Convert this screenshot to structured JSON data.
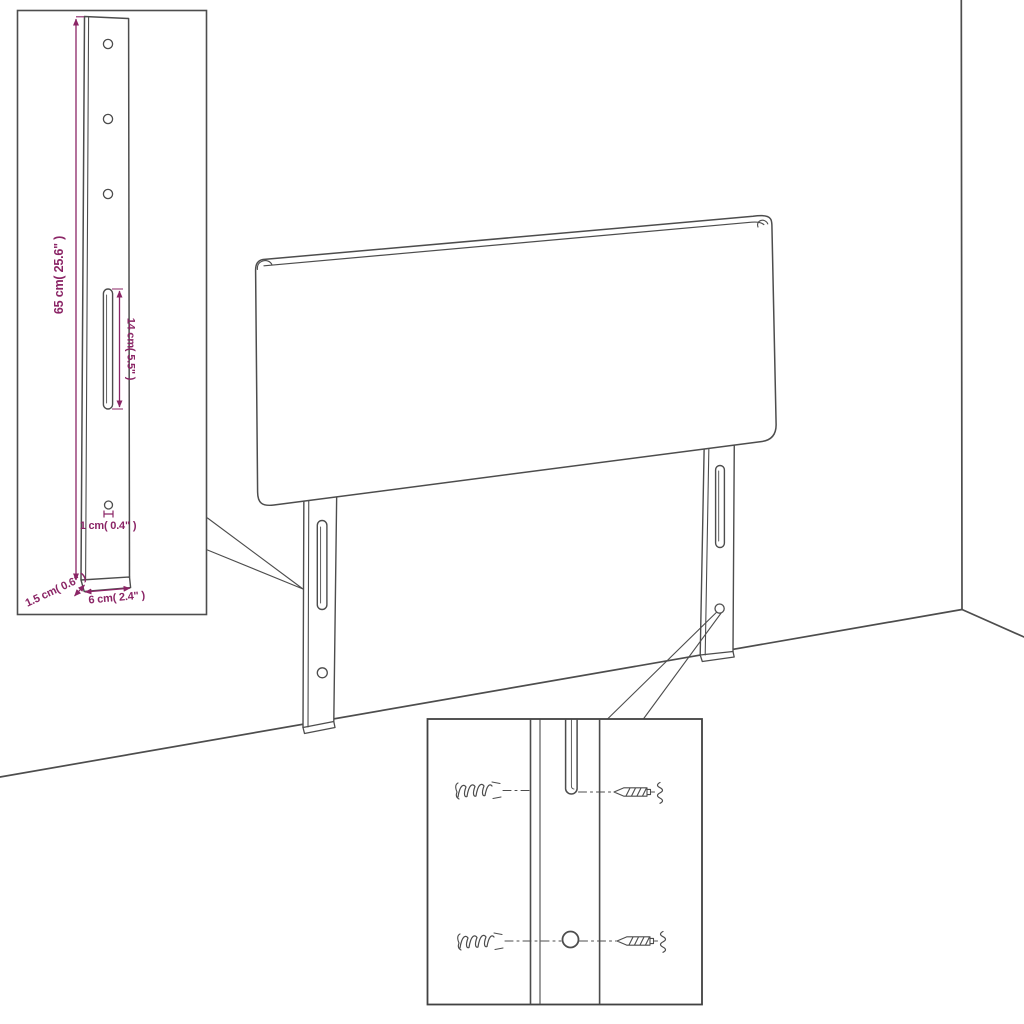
{
  "title": "Headboard mounting diagram",
  "colors": {
    "background": "#ffffff",
    "line": "#4d4d4d",
    "dimension": "#8b2566"
  },
  "leg_detail_inset": {
    "dimensions": {
      "height": "65 cm( 25.6\" )",
      "slot_length": "14 cm( 5.5\" )",
      "hole_diameter": "1 cm( 0.4\" )",
      "thickness": "1.5 cm( 0.6\" )",
      "width": "6 cm( 2.4\" )"
    }
  },
  "mounting_detail_inset": {
    "hardware": {
      "anchor": "wall-anchor",
      "screw": "mounting-screw"
    }
  }
}
